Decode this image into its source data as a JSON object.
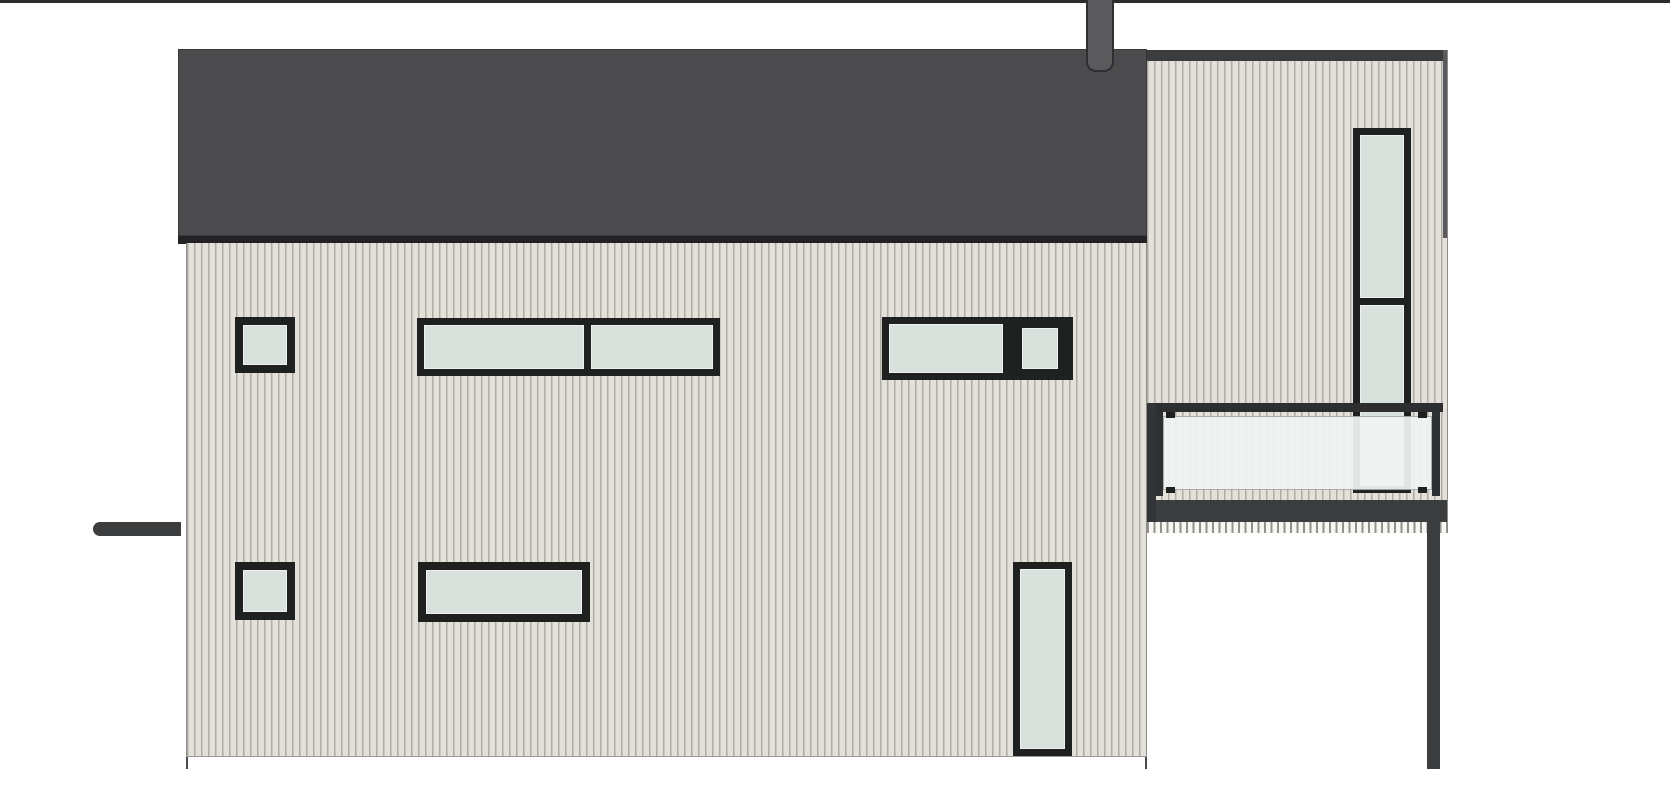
{
  "document": {
    "kind": "architectural elevation drawing",
    "view": "side elevation of a two-storey house with cantilevered upper volume and balcony",
    "visible_text": []
  },
  "palette": {
    "bg": "#ffffff",
    "roof": "#4b4b4d",
    "roof_fascia": "#232325",
    "chimney": "#5a5a5c",
    "outline": "#2f2f31",
    "siding_light": "#e3e1d9",
    "siding_stripe": "#aeaca4",
    "tick_dark": "#93918b",
    "tick_light": "#f7f6f2",
    "window_frame": "#1f2121",
    "glass": "#d9e1dd",
    "balcony_glass": "#f1f4f3",
    "dark_steel": "#3c3d3f",
    "ground": "#2b2b2b"
  },
  "components": {
    "roof": "flat dark roof with fascia band and chimney",
    "chimney": "round-bottomed flue pipe above roofline",
    "main_facade": "vertical board siding, light grey",
    "tower": "right-hand siding volume with dark parapet band",
    "balcony": "frameless white glass balustrade with clamps and dark floor slab",
    "support_post": "slender steel column under cantilever",
    "canopy": "small dark awning at left wall",
    "ground_line": "site ground line across full width",
    "window_count": 7,
    "windows": [
      "upper small square window (left)",
      "upper horizontal ribbon window, two panes",
      "upper window pair: wide fixed pane + small opening sash",
      "lower small square window (left)",
      "lower horizontal single-pane window",
      "lower full-height narrow window",
      "tower tall two-pane window"
    ]
  }
}
